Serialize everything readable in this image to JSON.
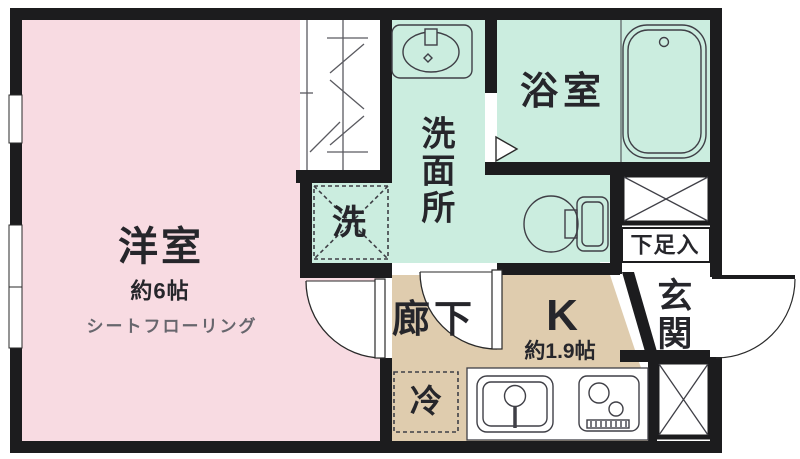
{
  "floor_plan": {
    "rooms": {
      "western_room": {
        "label": "洋室",
        "size": "約6帖",
        "flooring": "シートフローリング"
      },
      "washroom": {
        "label": "洗面所"
      },
      "bathroom": {
        "label": "浴室"
      },
      "hallway": {
        "label": "廊下"
      },
      "kitchen": {
        "label": "K",
        "size": "約1.9帖"
      },
      "entrance": {
        "label": "玄関"
      },
      "shoe_storage": {
        "label": "下足入"
      }
    },
    "fixtures": {
      "washing_machine": {
        "label": "洗"
      },
      "refrigerator": {
        "label": "冷"
      }
    },
    "colors": {
      "western_room": "#f8dbe2",
      "wet_area": "#cbeddf",
      "kitchen": "#dfccae",
      "wall": "#1c1c1e",
      "background": "#ffffff"
    }
  }
}
